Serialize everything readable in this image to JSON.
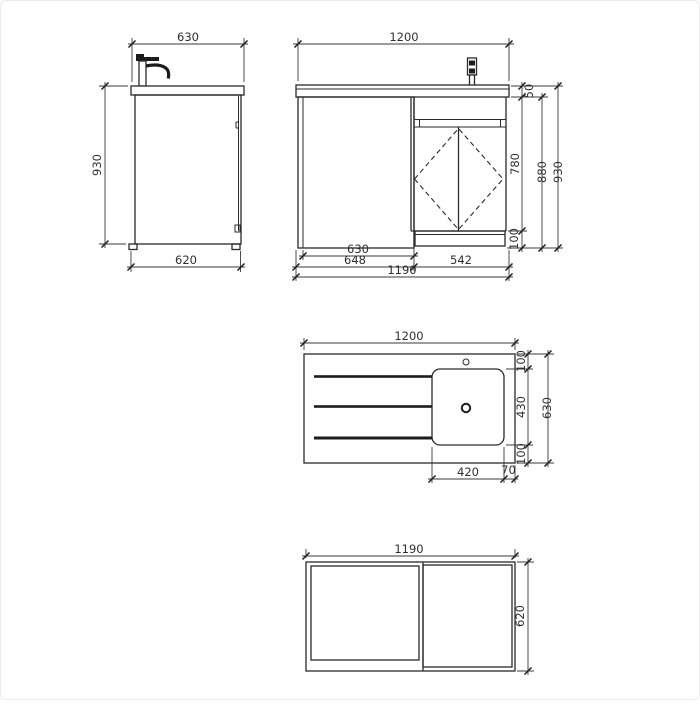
{
  "colors": {
    "background": "#ffffff",
    "line": "#2a2a2a",
    "dimension_line": "#3a3a3a",
    "text": "#2f2f2f"
  },
  "views": {
    "side": {
      "dim_width_top": "630",
      "dim_height": "930",
      "dim_width_bottom": "620"
    },
    "front": {
      "dim_width_top": "1200",
      "dim_counter_height": "50",
      "dim_carcass_height": "780",
      "dim_plinth_height": "100",
      "dim_carcass_plus_plinth": "880",
      "dim_total_height": "930",
      "dim_left_panel": "630",
      "dim_left_section": "648",
      "dim_right_section": "542",
      "dim_width_bottom": "1190"
    },
    "plan": {
      "dim_width": "1200",
      "dim_top_margin": "100",
      "dim_basin_depth": "430",
      "dim_bottom_margin": "100",
      "dim_total_depth": "630",
      "dim_basin_width": "420",
      "dim_right_margin": "70"
    },
    "bottom": {
      "dim_width": "1190",
      "dim_depth": "620"
    }
  }
}
